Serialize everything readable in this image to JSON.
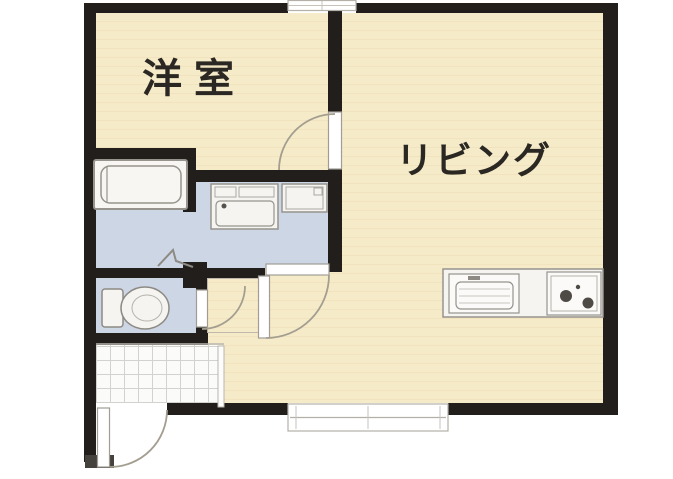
{
  "floor_plan": {
    "labels": {
      "western_room": "洋室",
      "living": "リビング"
    },
    "rooms": [
      {
        "id": "western-room",
        "label": "洋室"
      },
      {
        "id": "living-room",
        "label": "リビング"
      },
      {
        "id": "bathroom",
        "label": ""
      },
      {
        "id": "washroom",
        "label": ""
      },
      {
        "id": "toilet-room",
        "label": ""
      },
      {
        "id": "entrance",
        "label": ""
      }
    ],
    "fixtures": [
      "bathtub",
      "vanity-unit",
      "washing-machine-pan",
      "toilet",
      "kitchen-sink",
      "gas-stove",
      "folding-bath-door",
      "entrance-door",
      "north-window",
      "south-sliding-window"
    ],
    "colors": {
      "floor_cream": "#f6ebc9",
      "floor_wet_blue": "#cdd6e5",
      "wall_black": "#211e1b",
      "fixture_outline": "#97938d",
      "door_arc": "#a49e90",
      "tile_white": "#fbfbf9",
      "text": "#2b2824"
    }
  }
}
